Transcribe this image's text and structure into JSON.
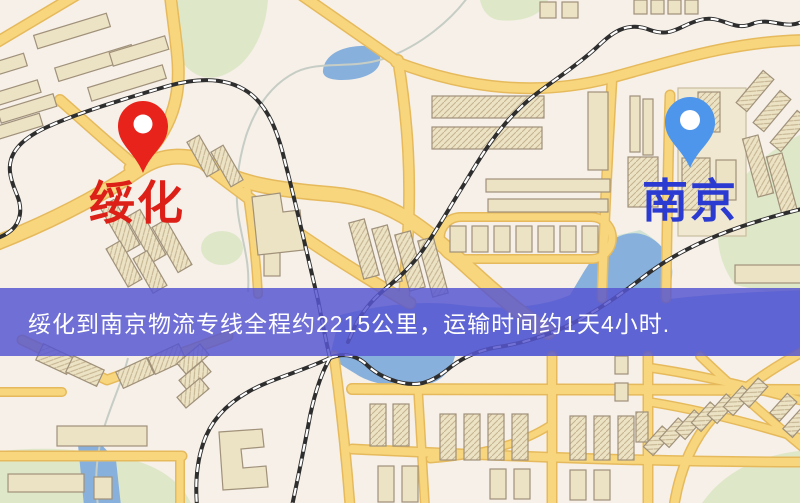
{
  "banner": {
    "text": "绥化到南京物流专线全程约2215公里，运输时间约1天4小时.",
    "background_color": "#5656d0",
    "text_color": "#ffffff"
  },
  "markers": {
    "origin": {
      "label": "绥化",
      "label_color": "#dd2017",
      "pin_color": "#e8231b"
    },
    "destination": {
      "label": "南京",
      "label_color": "#2b3bd2",
      "pin_color": "#4e95ec"
    }
  },
  "map_colors": {
    "background": "#f6f0e8",
    "road_fill": "#f7d67e",
    "road_casing": "#e6ba5c",
    "building_fill": "#ece2c4",
    "building_outline": "#a0917a",
    "green_area": "#dfe7c9",
    "water": "#88b0dc",
    "railway": "#2e2e2e"
  }
}
